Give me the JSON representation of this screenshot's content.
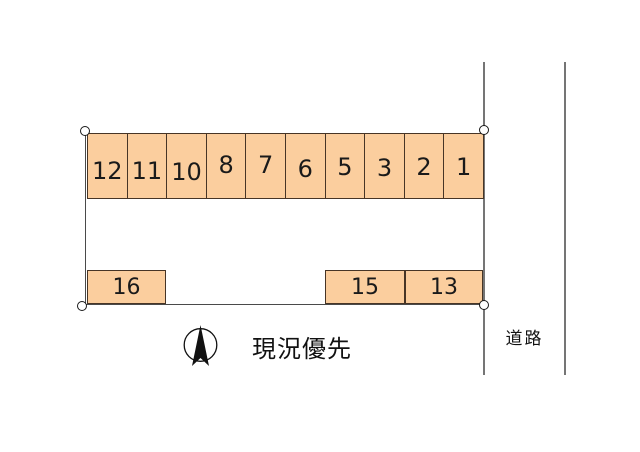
{
  "diagram": {
    "kind": "parking-lot-layout",
    "caption": "現況優先",
    "road_label": "道路"
  },
  "stalls": {
    "top_row": [
      "12",
      "11",
      "10",
      "8",
      "7",
      "6",
      "5",
      "3",
      "2",
      "1"
    ],
    "bottom_row": [
      "16",
      "15",
      "13"
    ]
  },
  "icons": {
    "compass": "north-arrow",
    "corner_marker": "open-circle-survey-point"
  },
  "colors": {
    "stall_fill": "#fbce9e",
    "stall_border": "#473526",
    "boundary": "#4a4a4a",
    "road_line": "#757575",
    "ink": "#111111"
  }
}
